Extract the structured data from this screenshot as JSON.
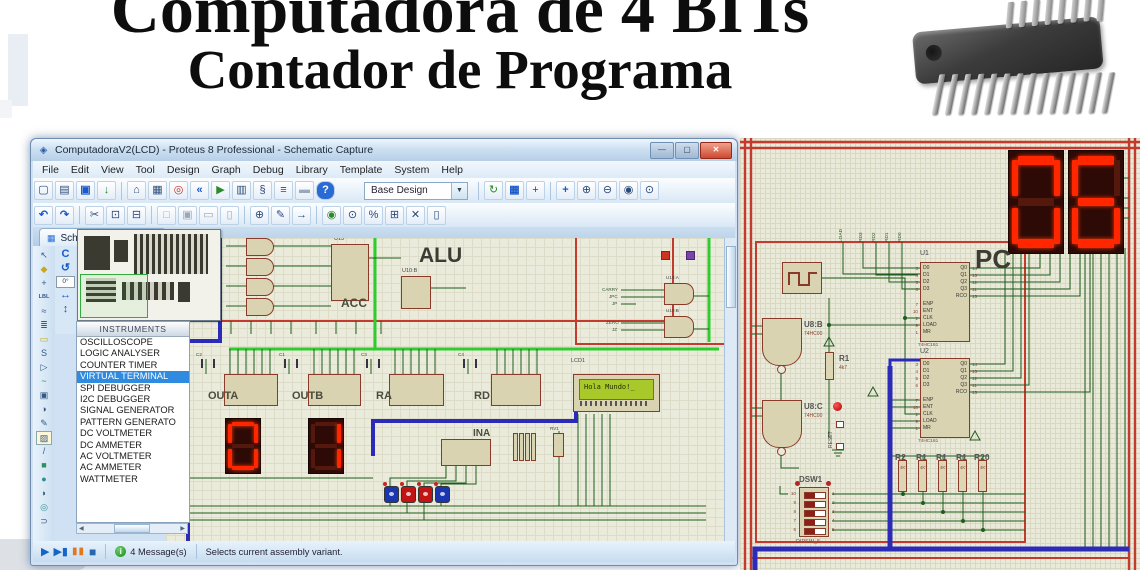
{
  "banner": {
    "line1": "Computadora de 4 BITs",
    "line2": "Contador de Programa"
  },
  "window": {
    "logo": "◈",
    "title": "ComputadoraV2(LCD) - Proteus 8 Professional - Schematic Capture",
    "controls": {
      "minimize": "—",
      "maximize": "▢",
      "close": "✕"
    },
    "menus": [
      "File",
      "Edit",
      "View",
      "Tool",
      "Design",
      "Graph",
      "Debug",
      "Library",
      "Template",
      "System",
      "Help"
    ],
    "variant_dropdown": "Base Design",
    "dropdown_arrow": "▼",
    "tab_icon": "▦",
    "tab_label": "Schematic Capture",
    "tab_close": "✕",
    "rotate_tools": {
      "refresh": "C",
      "rotate_ccw": "↺",
      "angle": "0°",
      "mirror_h": "↔",
      "mirror_v": "↕"
    },
    "scroll_left": "◀",
    "scroll_right": "▶",
    "status": {
      "play": "▶",
      "step": "▶▮",
      "pause": "▮▮",
      "stop": "■",
      "info_glyph": "i",
      "messages": "4 Message(s)",
      "hint": "Selects current assembly variant."
    }
  },
  "toolbars": {
    "main": [
      "▢",
      "▤",
      "▣",
      "↓",
      "⌂",
      "▦",
      "◎",
      "«",
      "▶",
      "▥",
      "§",
      "≡",
      "▬",
      "?"
    ],
    "edit": [
      "↶",
      "↷",
      "✂",
      "⊡",
      "⊟",
      "□",
      "▣",
      "▭",
      "▯",
      "⊕",
      "✎",
      "→",
      "◉",
      "⊙",
      "%",
      "⊞",
      "✕",
      "▯"
    ],
    "view": [
      "↻",
      "▦",
      "+",
      "+",
      "⊕",
      "⊖",
      "◉",
      "⊙"
    ],
    "side": [
      "↖",
      "◆",
      "+",
      "LBL",
      "≈",
      "≣",
      "▭",
      "S",
      "▷",
      "~",
      "▣",
      "◑",
      "✎",
      "▨",
      "/",
      "■",
      "●",
      "◗",
      "◎",
      "⊃"
    ]
  },
  "instruments": {
    "header": "INSTRUMENTS",
    "items": [
      "OSCILLOSCOPE",
      "LOGIC ANALYSER",
      "COUNTER TIMER",
      "VIRTUAL TERMINAL",
      "SPI DEBUGGER",
      "I2C DEBUGGER",
      "SIGNAL GENERATOR",
      "PATTERN GENERATO",
      "DC VOLTMETER",
      "DC AMMETER",
      "AC VOLTMETER",
      "AC AMMETER",
      "WATTMETER"
    ]
  },
  "schematic": {
    "alu": "ALU",
    "acc": "ACC",
    "u13": "U13",
    "u10b": "U10:B",
    "u19a": "U19:A",
    "u19b": "U19:B",
    "outa": "OUTA",
    "outb": "OUTB",
    "ra": "RA",
    "rd": "RD",
    "ina": "INA",
    "lcd_ref": "LCD1",
    "lcd_text": "Hola Mundo!_",
    "pot_ref": "RV1",
    "caps": [
      "C2",
      "C1",
      "C3",
      "C4"
    ],
    "display_left": "0",
    "display_right": "1",
    "gate_inputs": [
      "CARRY",
      "JPC",
      "JP",
      "ZERO",
      "JZ"
    ]
  },
  "pc_panel": {
    "pc_label": "PC",
    "digit_left": "0",
    "digit_right": "6",
    "terminals": [
      "LOAD",
      "RD3",
      "RD2",
      "RD1",
      "RD0"
    ],
    "u1_ref": "U1",
    "u2_ref": "U2",
    "u161": {
      "part": "74HC161",
      "d_pins": "D0\nD1\nD2\nD3",
      "d_nums": "3\n4\n5\n6",
      "ctrl_pins": "ENP\nENT\nCLK\nLOAD\nMR",
      "ctrl_nums": "7\n10\n2\n9\n1",
      "q_pins": "Q0\nQ1\nQ2\nQ3",
      "q_nums": "14\n13\n12\n11",
      "rco": "RCO",
      "rco_num": "15"
    },
    "u8b_ref": "U8:B",
    "u8c_ref": "U8:C",
    "u8_part": "74HC00",
    "r1_ref": "R1",
    "r1_value": "4k7",
    "reset_label": "RESET",
    "pull_resistors": [
      "R2",
      "R1",
      "R1",
      "R1",
      "R20"
    ],
    "pull_value": "4K7",
    "dsw_ref": "DSW1",
    "dsw_part": "DIPSW_5",
    "dsw_pins_right": "1\n2\n3\n4\n5",
    "dsw_pins_left": "10\n9\n8\n7\n6"
  }
}
